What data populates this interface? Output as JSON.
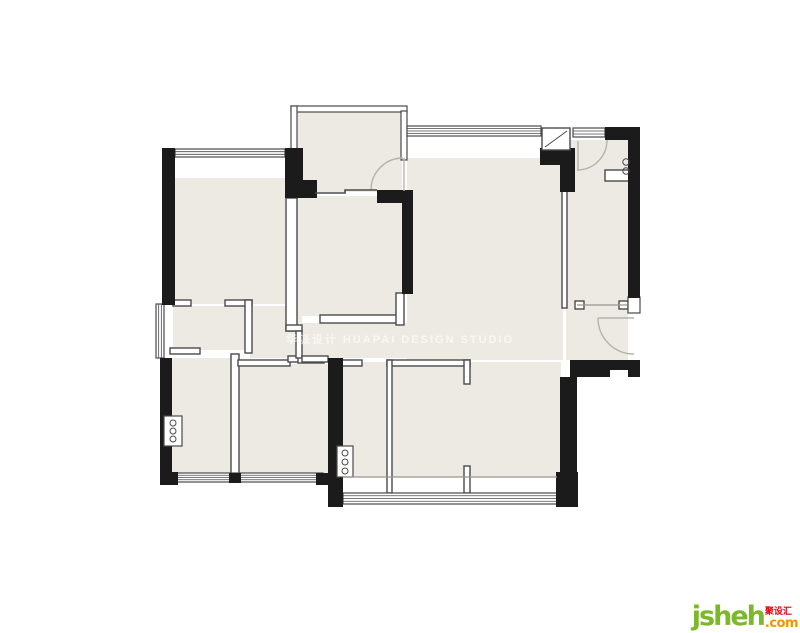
{
  "watermark": {
    "text": "华派设计 HUAPAI DESIGN STUDIO"
  },
  "logo": {
    "brand": "jsheh",
    "cjk": "聚设汇",
    "tld": ".com",
    "green": "#7cb829",
    "orange": "#f29400",
    "red": "#e60012"
  },
  "floorplan": {
    "colors": {
      "room_fill": "#edeae3",
      "wall_black": "#1b1b1b",
      "line_dark": "#4a4a4a",
      "arc_gray": "#b8b2a9",
      "light_line": "#9a958d",
      "white": "#ffffff"
    },
    "room_fills": [
      [
        175,
        178,
        110,
        126
      ],
      [
        296,
        112,
        106,
        80
      ],
      [
        297,
        196,
        106,
        120
      ],
      [
        173,
        306,
        74,
        44
      ],
      [
        250,
        306,
        52,
        52
      ],
      [
        300,
        323,
        108,
        35
      ],
      [
        407,
        158,
        156,
        202
      ],
      [
        342,
        362,
        219,
        115
      ],
      [
        566,
        140,
        62,
        220
      ],
      [
        172,
        358,
        60,
        116
      ],
      [
        237,
        364,
        91,
        110
      ]
    ],
    "railings": [
      [
        291,
        106,
        116,
        6
      ],
      [
        291,
        106,
        6,
        89
      ],
      [
        401,
        111,
        6,
        49
      ]
    ],
    "partitions": [
      [
        173,
        300,
        18,
        6
      ],
      [
        225,
        300,
        27,
        6
      ],
      [
        245,
        300,
        7,
        53
      ],
      [
        170,
        348,
        30,
        6
      ],
      [
        231,
        354,
        8,
        121
      ],
      [
        238,
        360,
        52,
        6
      ],
      [
        288,
        356,
        12,
        6
      ],
      [
        298,
        357,
        26,
        6
      ],
      [
        286,
        198,
        11,
        133
      ],
      [
        286,
        325,
        16,
        6
      ],
      [
        296,
        331,
        6,
        27
      ],
      [
        302,
        356,
        26,
        6
      ],
      [
        320,
        315,
        78,
        8
      ],
      [
        396,
        293,
        8,
        32
      ],
      [
        342,
        360,
        20,
        6
      ],
      [
        387,
        360,
        83,
        6
      ],
      [
        387,
        360,
        5,
        133
      ],
      [
        464,
        360,
        6,
        24
      ],
      [
        464,
        466,
        6,
        27
      ],
      [
        562,
        190,
        5,
        118
      ],
      [
        605,
        170,
        25,
        11
      ],
      [
        575,
        301,
        9,
        8
      ],
      [
        619,
        301,
        9,
        8
      ]
    ],
    "windows": [
      {
        "r": [
          175,
          149,
          110,
          8
        ],
        "lines": 2,
        "o": "h"
      },
      {
        "r": [
          407,
          126,
          134,
          10
        ],
        "lines": 3,
        "o": "h"
      },
      {
        "r": [
          573,
          128,
          32,
          9
        ],
        "lines": 2,
        "o": "h"
      },
      {
        "r": [
          156,
          304,
          8,
          54
        ],
        "lines": 2,
        "o": "v"
      },
      {
        "r": [
          177,
          473,
          146,
          9
        ],
        "lines": 3,
        "o": "h"
      },
      {
        "r": [
          343,
          493,
          215,
          11
        ],
        "lines": 3,
        "o": "h"
      },
      {
        "r": [
          628,
          297,
          12,
          16
        ],
        "lines": 0,
        "o": "v"
      }
    ],
    "walls": [
      [
        162,
        148,
        13,
        157
      ],
      [
        285,
        148,
        18,
        50
      ],
      [
        297,
        180,
        20,
        18
      ],
      [
        377,
        190,
        36,
        13
      ],
      [
        402,
        190,
        11,
        104
      ],
      [
        540,
        148,
        35,
        17
      ],
      [
        560,
        165,
        15,
        27
      ],
      [
        605,
        127,
        35,
        13
      ],
      [
        628,
        140,
        12,
        158
      ],
      [
        570,
        360,
        70,
        17
      ],
      [
        560,
        377,
        17,
        98
      ],
      [
        556,
        472,
        22,
        35
      ],
      [
        328,
        358,
        15,
        149
      ],
      [
        160,
        358,
        12,
        116
      ],
      [
        160,
        472,
        18,
        13
      ],
      [
        229,
        473,
        12,
        10
      ],
      [
        316,
        473,
        12,
        12
      ]
    ],
    "notches": [
      [
        610,
        370,
        18,
        7
      ]
    ],
    "flue": {
      "box": [
        542,
        128,
        28,
        22
      ],
      "diag": [
        545,
        147,
        567,
        131
      ]
    },
    "fixture_boxes": [
      {
        "box": [
          164,
          416,
          18,
          30
        ],
        "circles": [
          [
            173,
            423
          ],
          [
            173,
            431
          ],
          [
            173,
            439
          ]
        ]
      },
      {
        "box": [
          337,
          446,
          16,
          31
        ],
        "circles": [
          [
            345,
            453
          ],
          [
            345,
            462
          ],
          [
            345,
            471
          ]
        ]
      }
    ],
    "small_circles": [
      [
        626,
        162
      ],
      [
        626,
        171
      ]
    ],
    "door_arcs": [
      "M371,190 A32,32 0 0 1 403,158",
      "M607,140 A30,30 0 0 1 577,170",
      "M598,318 A36,36 0 0 0 634,354"
    ],
    "leaf_lines": [
      [
        404,
        158,
        404,
        191
      ],
      [
        578,
        141,
        578,
        171
      ],
      [
        598,
        318,
        634,
        318
      ]
    ],
    "slide_door_points": "315,193 345,193 345,190 377,190",
    "light_lines": [
      [
        343,
        477,
        557,
        477
      ],
      [
        577,
        305,
        627,
        305
      ]
    ]
  }
}
